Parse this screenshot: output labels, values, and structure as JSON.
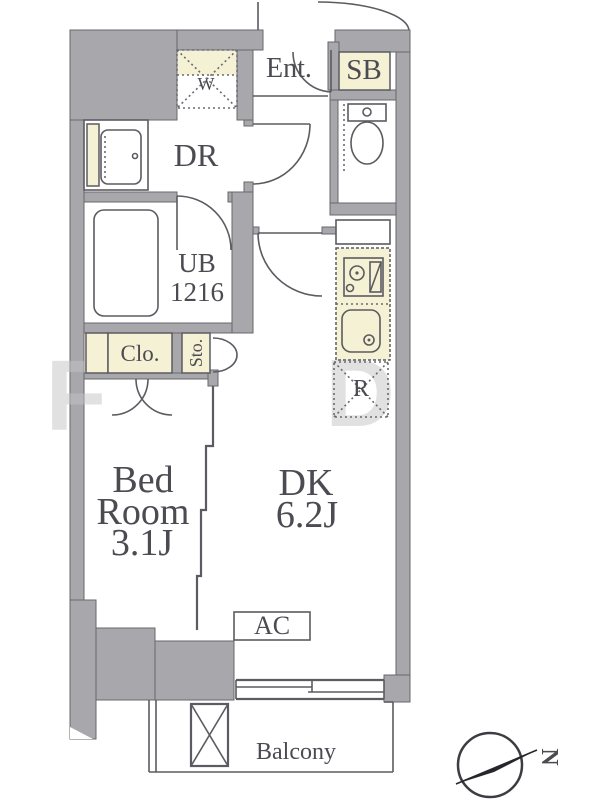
{
  "floorplan": {
    "labels": {
      "entrance": "Ent.",
      "shoe_box": "SB",
      "dressing_room": "DR",
      "washer": "W",
      "unit_bath_line1": "UB",
      "unit_bath_line2": "1216",
      "closet": "Clo.",
      "storage": "Sto.",
      "bedroom_line1": "Bed",
      "bedroom_line2": "Room",
      "bedroom_line3": "3.1J",
      "dk_line1": "DK",
      "dk_line2": "6.2J",
      "refrigerator": "R",
      "air_conditioning": "AC",
      "balcony": "Balcony"
    },
    "compass": {
      "direction": "N"
    },
    "watermark": {
      "left_letter": "F",
      "right_letter": "D"
    },
    "colors": {
      "wall": "#a8a8ac",
      "fixture_yellow": "#f5f1d4",
      "line": "#5b5b61",
      "text": "#4b4b52"
    }
  }
}
